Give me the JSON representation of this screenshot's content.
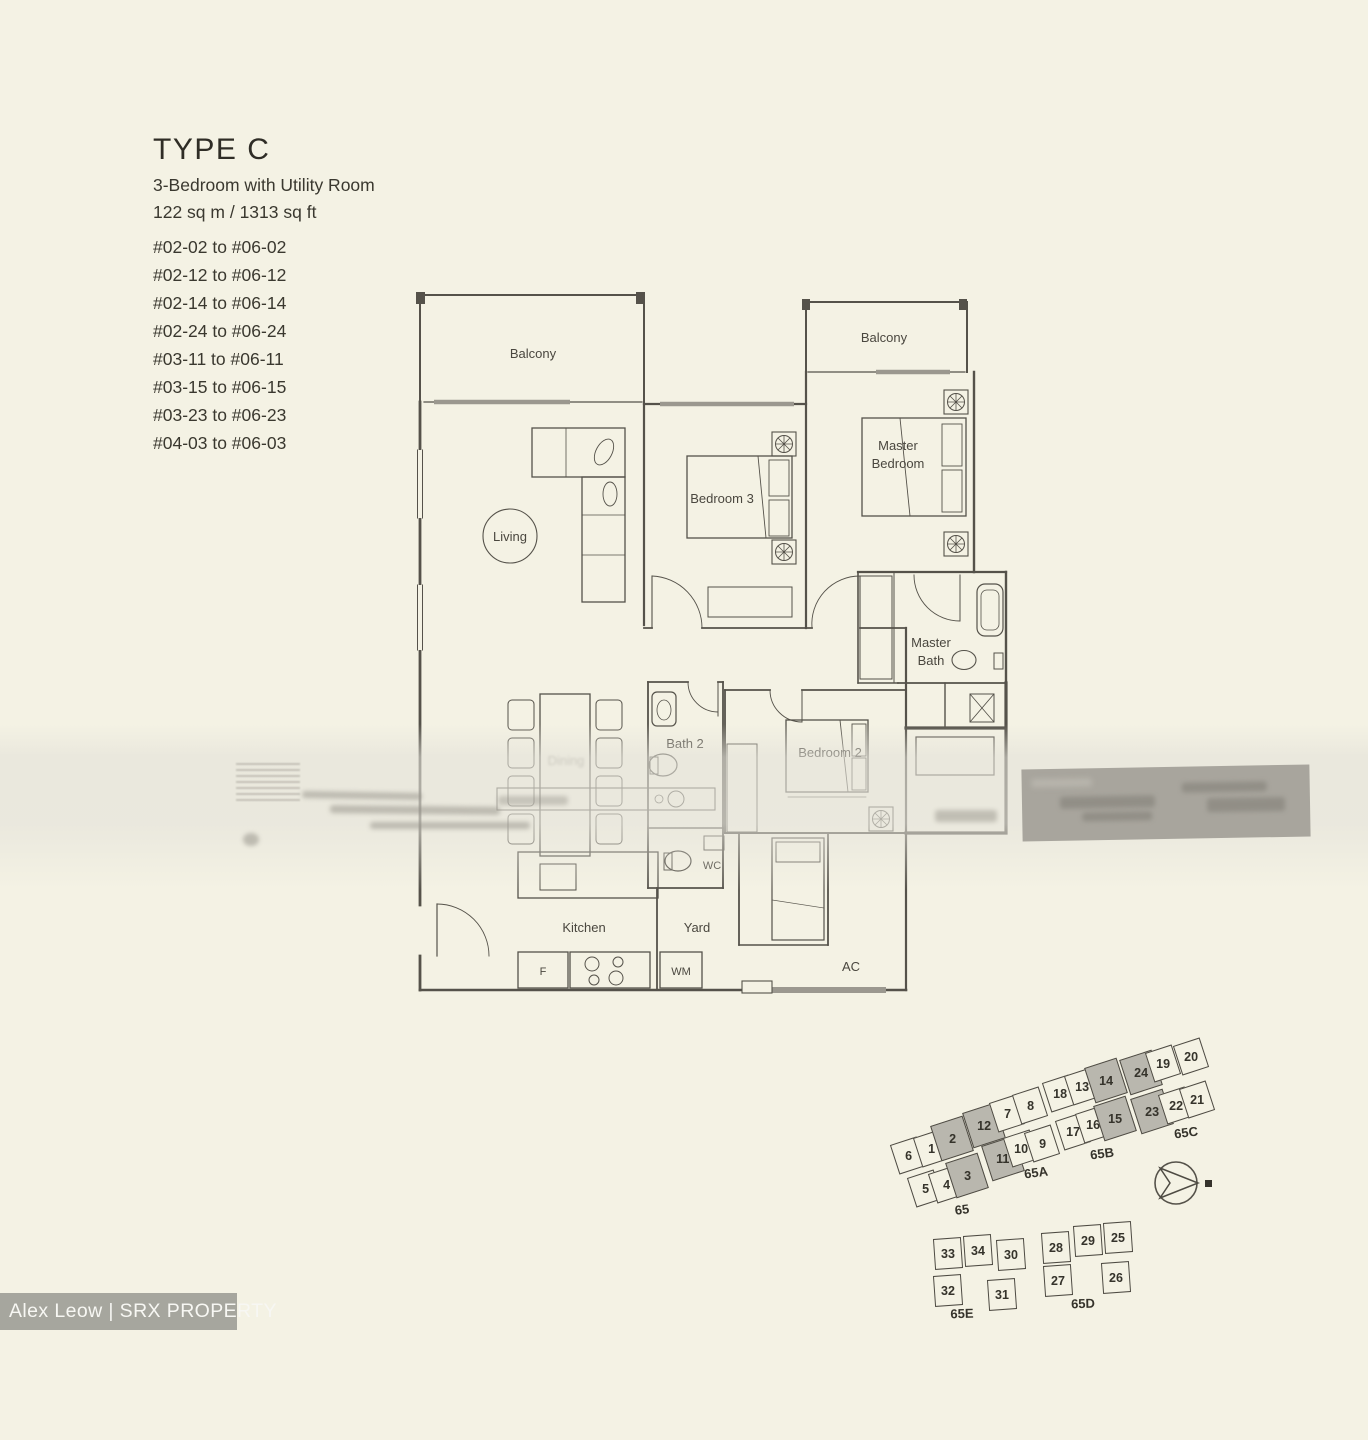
{
  "header": {
    "type_label": "TYPE C",
    "subtitle": "3-Bedroom with Utility Room",
    "area": "122 sq m / 1313 sq ft",
    "unit_ranges": [
      "#02-02 to #06-02",
      "#02-12 to #06-12",
      "#02-14 to #06-14",
      "#02-24 to #06-24",
      "#03-11 to #06-11",
      "#03-15 to #06-15",
      "#03-23 to #06-23",
      "#04-03 to #06-03"
    ]
  },
  "floorplan": {
    "labels": {
      "balcony_left": "Balcony",
      "balcony_right": "Balcony",
      "living": "Living",
      "dining": "Dining",
      "bedroom3": "Bedroom 3",
      "master_bedroom_line1": "Master",
      "master_bedroom_line2": "Bedroom",
      "master_bath_line1": "Master",
      "master_bath_line2": "Bath",
      "bath2": "Bath 2",
      "bedroom2": "Bedroom 2",
      "wc": "WC",
      "kitchen": "Kitchen",
      "yard": "Yard",
      "fridge": "F",
      "washing_machine": "WM",
      "aircon_ledge": "AC"
    }
  },
  "siteplan": {
    "clusters": [
      {
        "id": "upper",
        "tilt": -18,
        "units": [
          {
            "n": "6",
            "x": 908,
            "y": 1155
          },
          {
            "n": "1",
            "x": 931,
            "y": 1148
          },
          {
            "n": "2",
            "x": 952,
            "y": 1138,
            "shaded": true
          },
          {
            "n": "12",
            "x": 984,
            "y": 1125,
            "shaded": true
          },
          {
            "n": "7",
            "x": 1007,
            "y": 1113
          },
          {
            "n": "8",
            "x": 1030,
            "y": 1105
          },
          {
            "n": "18",
            "x": 1060,
            "y": 1093
          },
          {
            "n": "13",
            "x": 1082,
            "y": 1086
          },
          {
            "n": "14",
            "x": 1106,
            "y": 1080,
            "shaded": true
          },
          {
            "n": "24",
            "x": 1141,
            "y": 1072,
            "shaded": true
          },
          {
            "n": "19",
            "x": 1163,
            "y": 1063
          },
          {
            "n": "20",
            "x": 1191,
            "y": 1056
          },
          {
            "n": "5",
            "x": 925,
            "y": 1188
          },
          {
            "n": "4",
            "x": 946,
            "y": 1184
          },
          {
            "n": "3",
            "x": 967,
            "y": 1175,
            "shaded": true
          },
          {
            "n": "11",
            "x": 1003,
            "y": 1158,
            "shaded": true
          },
          {
            "n": "10",
            "x": 1021,
            "y": 1148
          },
          {
            "n": "9",
            "x": 1042,
            "y": 1143
          },
          {
            "n": "17",
            "x": 1073,
            "y": 1131
          },
          {
            "n": "16",
            "x": 1093,
            "y": 1124
          },
          {
            "n": "15",
            "x": 1115,
            "y": 1118,
            "shaded": true
          },
          {
            "n": "23",
            "x": 1152,
            "y": 1111,
            "shaded": true
          },
          {
            "n": "22",
            "x": 1176,
            "y": 1105
          },
          {
            "n": "21",
            "x": 1197,
            "y": 1099
          }
        ],
        "labels": [
          {
            "text": "65",
            "x": 962,
            "y": 1211
          },
          {
            "text": "65A",
            "x": 1036,
            "y": 1174
          },
          {
            "text": "65B",
            "x": 1102,
            "y": 1155
          },
          {
            "text": "65C",
            "x": 1186,
            "y": 1134
          }
        ]
      },
      {
        "id": "lower",
        "tilt": -4,
        "units": [
          {
            "n": "33",
            "x": 948,
            "y": 1253
          },
          {
            "n": "34",
            "x": 978,
            "y": 1250
          },
          {
            "n": "30",
            "x": 1011,
            "y": 1254
          },
          {
            "n": "32",
            "x": 948,
            "y": 1290
          },
          {
            "n": "31",
            "x": 1002,
            "y": 1294
          },
          {
            "n": "28",
            "x": 1056,
            "y": 1247
          },
          {
            "n": "29",
            "x": 1088,
            "y": 1240
          },
          {
            "n": "25",
            "x": 1118,
            "y": 1237
          },
          {
            "n": "27",
            "x": 1058,
            "y": 1280
          },
          {
            "n": "26",
            "x": 1116,
            "y": 1277
          }
        ],
        "labels": [
          {
            "text": "65E",
            "x": 962,
            "y": 1315
          },
          {
            "text": "65D",
            "x": 1083,
            "y": 1305
          }
        ]
      }
    ]
  },
  "watermark": {
    "text": "Alex Leow | SRX PROPERTY"
  },
  "colors": {
    "background": "#f4f2e4",
    "plan_line": "#55524a",
    "window_gray": "#9b988f",
    "shaded_unit": "#b9b7ae",
    "watermark_bar": "#a6a69e",
    "redacted_box": "#a8a59d",
    "text": "#3a382f"
  }
}
